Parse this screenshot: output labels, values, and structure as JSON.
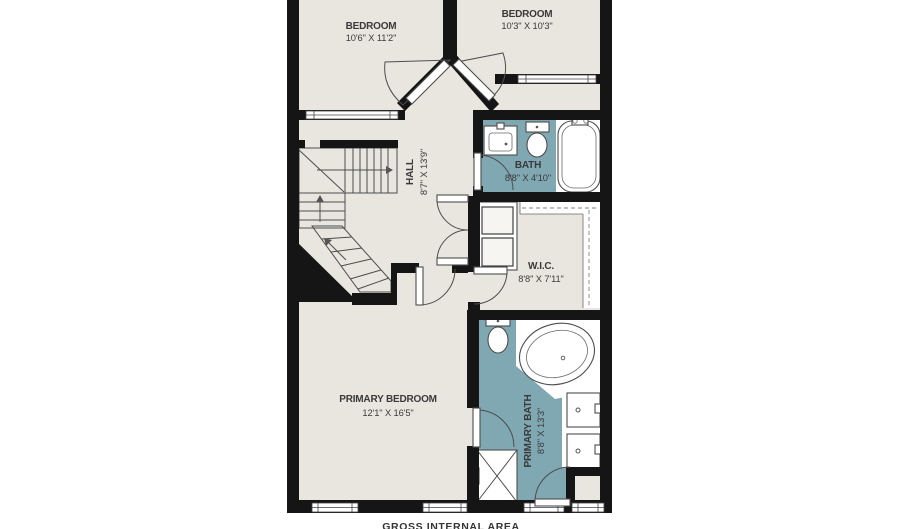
{
  "colors": {
    "floor": "#e8e6de",
    "tile": "#7fa8b2",
    "wall": "#151515",
    "line": "#4d4d4d",
    "label": "#3a3a3a",
    "background": "#ffffff"
  },
  "rooms": [
    {
      "id": "bedroom-1",
      "name": "BEDROOM",
      "dims": "10'6\" X 11'2\""
    },
    {
      "id": "bedroom-2",
      "name": "BEDROOM",
      "dims": "10'3\" X 10'3\""
    },
    {
      "id": "bath",
      "name": "BATH",
      "dims": "8'8\" X 4'10\""
    },
    {
      "id": "hall",
      "name": "HALL",
      "dims": "8'7\" X 13'9\""
    },
    {
      "id": "wic",
      "name": "W.I.C.",
      "dims": "8'8\" X 7'11\""
    },
    {
      "id": "primary-bedroom",
      "name": "PRIMARY BEDROOM",
      "dims": "12'1\" X 16'5\""
    },
    {
      "id": "primary-bath",
      "name": "PRIMARY BATH",
      "dims": "8'8\" X 13'3\""
    }
  ],
  "footer": {
    "label": "GROSS INTERNAL AREA"
  }
}
